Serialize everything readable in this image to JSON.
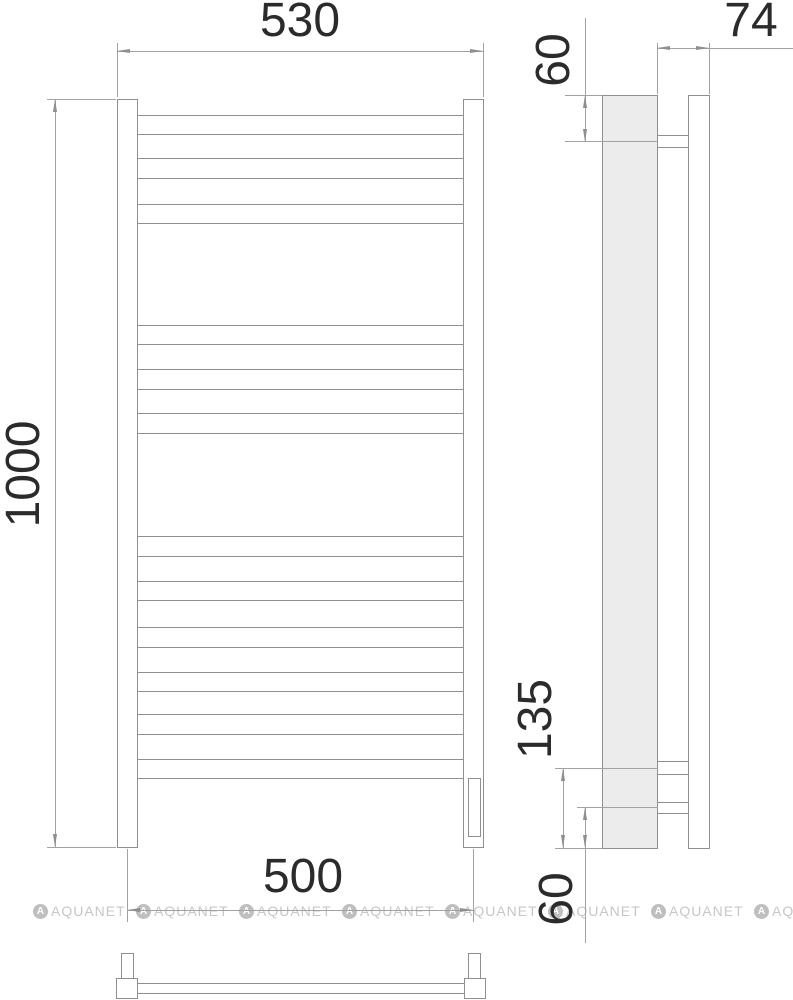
{
  "palette": {
    "object_line": "#8f8f8f",
    "dim_line": "#a2a2a2",
    "profile_fill": "#ececec",
    "text_color": "#2b2b2b",
    "watermark_color": "#c7c7c7"
  },
  "dimensions": {
    "top_width": "530",
    "side_depth": "74",
    "side_top_offset": "60",
    "height": "1000",
    "side_bracket_offset": "135",
    "side_bottom_offset": "60",
    "bottom_width": "500"
  },
  "watermark": {
    "text": "AQUANET",
    "count": 8,
    "start_x": 33,
    "period": 103,
    "y": 903
  },
  "shapes": {
    "rects": [
      {
        "name": "front-left-post",
        "x": 117,
        "y": 99,
        "w": 21,
        "h": 749,
        "fill": "#ffffff"
      },
      {
        "name": "front-right-post",
        "x": 463,
        "y": 99,
        "w": 21,
        "h": 749,
        "fill": "#ffffff"
      },
      {
        "name": "front-rung-1",
        "x": 137,
        "y": 115,
        "w": 327,
        "h": 20,
        "fill": "#ffffff"
      },
      {
        "name": "front-rung-2",
        "x": 137,
        "y": 158,
        "w": 327,
        "h": 21,
        "fill": "#ffffff"
      },
      {
        "name": "front-rung-3",
        "x": 137,
        "y": 204,
        "w": 327,
        "h": 20,
        "fill": "#ffffff"
      },
      {
        "name": "front-rung-4",
        "x": 137,
        "y": 325,
        "w": 327,
        "h": 20,
        "fill": "#ffffff"
      },
      {
        "name": "front-rung-5",
        "x": 137,
        "y": 369,
        "w": 327,
        "h": 21,
        "fill": "#ffffff"
      },
      {
        "name": "front-rung-6",
        "x": 137,
        "y": 413,
        "w": 327,
        "h": 21,
        "fill": "#ffffff"
      },
      {
        "name": "front-rung-7",
        "x": 137,
        "y": 536,
        "w": 327,
        "h": 21,
        "fill": "#ffffff"
      },
      {
        "name": "front-rung-8",
        "x": 137,
        "y": 581,
        "w": 327,
        "h": 20,
        "fill": "#ffffff"
      },
      {
        "name": "front-rung-9",
        "x": 137,
        "y": 627,
        "w": 327,
        "h": 21,
        "fill": "#ffffff"
      },
      {
        "name": "front-rung-10",
        "x": 137,
        "y": 672,
        "w": 327,
        "h": 20,
        "fill": "#ffffff"
      },
      {
        "name": "front-rung-11",
        "x": 137,
        "y": 714,
        "w": 327,
        "h": 21,
        "fill": "#ffffff"
      },
      {
        "name": "front-rung-12",
        "x": 137,
        "y": 759,
        "w": 327,
        "h": 20,
        "fill": "#ffffff"
      },
      {
        "name": "heating-element",
        "x": 468,
        "y": 778,
        "w": 13,
        "h": 59,
        "fill": "#ffffff"
      },
      {
        "name": "side-rail-profile",
        "x": 602,
        "y": 95,
        "w": 56,
        "h": 754,
        "fill": "#ececec"
      },
      {
        "name": "side-wall-plate",
        "x": 688,
        "y": 95,
        "w": 22,
        "h": 754,
        "fill": "#ffffff"
      },
      {
        "name": "side-bracket-top",
        "x": 657,
        "y": 135,
        "w": 32,
        "h": 13,
        "fill": "#ffffff"
      },
      {
        "name": "side-bracket-mid",
        "x": 657,
        "y": 761,
        "w": 32,
        "h": 14,
        "fill": "#ffffff"
      },
      {
        "name": "side-bracket-bottom",
        "x": 657,
        "y": 802,
        "w": 32,
        "h": 12,
        "fill": "#ffffff"
      },
      {
        "name": "plan-top-rung",
        "x": 137,
        "y": 983,
        "w": 328,
        "h": 11,
        "fill": "#ffffff"
      },
      {
        "name": "plan-left-bracket",
        "x": 121,
        "y": 953,
        "w": 13,
        "h": 26,
        "fill": "#ffffff"
      },
      {
        "name": "plan-right-bracket",
        "x": 468,
        "y": 953,
        "w": 13,
        "h": 26,
        "fill": "#ffffff"
      },
      {
        "name": "plan-left-post",
        "x": 116,
        "y": 978,
        "w": 22,
        "h": 21,
        "fill": "#ffffff"
      },
      {
        "name": "plan-right-post",
        "x": 464,
        "y": 978,
        "w": 22,
        "h": 21,
        "fill": "#ffffff"
      }
    ],
    "lines": [
      {
        "name": "ext-530-left",
        "x1": 117,
        "y1": 43,
        "x2": 117,
        "y2": 97,
        "k": "dim"
      },
      {
        "name": "ext-530-right",
        "x1": 483,
        "y1": 43,
        "x2": 483,
        "y2": 97,
        "k": "dim"
      },
      {
        "name": "dim-530",
        "x1": 117,
        "y1": 51,
        "x2": 483,
        "y2": 51,
        "k": "dim"
      },
      {
        "name": "ext-1000-top",
        "x1": 47,
        "y1": 99,
        "x2": 116,
        "y2": 99,
        "k": "dim"
      },
      {
        "name": "ext-1000-bottom",
        "x1": 47,
        "y1": 847,
        "x2": 116,
        "y2": 847,
        "k": "dim"
      },
      {
        "name": "dim-1000",
        "x1": 55,
        "y1": 99,
        "x2": 55,
        "y2": 847,
        "k": "dim"
      },
      {
        "name": "ext-500-left",
        "x1": 127,
        "y1": 849,
        "x2": 127,
        "y2": 922,
        "k": "dim"
      },
      {
        "name": "ext-500-right",
        "x1": 473,
        "y1": 849,
        "x2": 473,
        "y2": 922,
        "k": "dim"
      },
      {
        "name": "dim-500",
        "x1": 127,
        "y1": 910,
        "x2": 473,
        "y2": 910,
        "k": "dim"
      },
      {
        "name": "ext-74-left",
        "x1": 657,
        "y1": 43,
        "x2": 657,
        "y2": 94,
        "k": "dim"
      },
      {
        "name": "ext-74-right",
        "x1": 709,
        "y1": 43,
        "x2": 709,
        "y2": 94,
        "k": "dim"
      },
      {
        "name": "dim-74",
        "x1": 657,
        "y1": 48,
        "x2": 793,
        "y2": 48,
        "k": "dim"
      },
      {
        "name": "ext-side-top",
        "x1": 565,
        "y1": 95,
        "x2": 602,
        "y2": 95,
        "k": "dim"
      },
      {
        "name": "dim-60-top",
        "x1": 585,
        "y1": 18,
        "x2": 585,
        "y2": 142,
        "k": "dim"
      },
      {
        "name": "ext-bracket-top",
        "x1": 565,
        "y1": 141,
        "x2": 658,
        "y2": 141,
        "k": "dim"
      },
      {
        "name": "dim-135",
        "x1": 563,
        "y1": 768,
        "x2": 563,
        "y2": 848,
        "k": "dim"
      },
      {
        "name": "ext-bracket-mid",
        "x1": 555,
        "y1": 768,
        "x2": 658,
        "y2": 768,
        "k": "dim"
      },
      {
        "name": "dim-60-bottom",
        "x1": 585,
        "y1": 807,
        "x2": 585,
        "y2": 943,
        "k": "dim"
      },
      {
        "name": "ext-bracket-bottom",
        "x1": 577,
        "y1": 807,
        "x2": 658,
        "y2": 807,
        "k": "dim"
      },
      {
        "name": "ext-side-bottom",
        "x1": 555,
        "y1": 848,
        "x2": 602,
        "y2": 848,
        "k": "dim"
      }
    ],
    "arrows": [
      {
        "name": "arrow-530-left",
        "x": 117,
        "y": 51,
        "dir": "left"
      },
      {
        "name": "arrow-530-right",
        "x": 483,
        "y": 51,
        "dir": "right"
      },
      {
        "name": "arrow-1000-top",
        "x": 55,
        "y": 99,
        "dir": "up"
      },
      {
        "name": "arrow-1000-bottom",
        "x": 55,
        "y": 847,
        "dir": "down"
      },
      {
        "name": "arrow-500-left",
        "x": 127,
        "y": 910,
        "dir": "left"
      },
      {
        "name": "arrow-500-right",
        "x": 473,
        "y": 910,
        "dir": "right"
      },
      {
        "name": "arrow-74-left",
        "x": 657,
        "y": 48,
        "dir": "left"
      },
      {
        "name": "arrow-74-right",
        "x": 709,
        "y": 48,
        "dir": "right"
      },
      {
        "name": "arrow-60t-top",
        "x": 585,
        "y": 95,
        "dir": "up"
      },
      {
        "name": "arrow-60t-bottom",
        "x": 585,
        "y": 142,
        "dir": "down"
      },
      {
        "name": "arrow-135-top",
        "x": 563,
        "y": 768,
        "dir": "up"
      },
      {
        "name": "arrow-135-bottom",
        "x": 563,
        "y": 848,
        "dir": "down"
      },
      {
        "name": "arrow-60b-top",
        "x": 585,
        "y": 807,
        "dir": "up"
      },
      {
        "name": "arrow-60b-bottom",
        "x": 585,
        "y": 848,
        "dir": "down"
      }
    ]
  }
}
